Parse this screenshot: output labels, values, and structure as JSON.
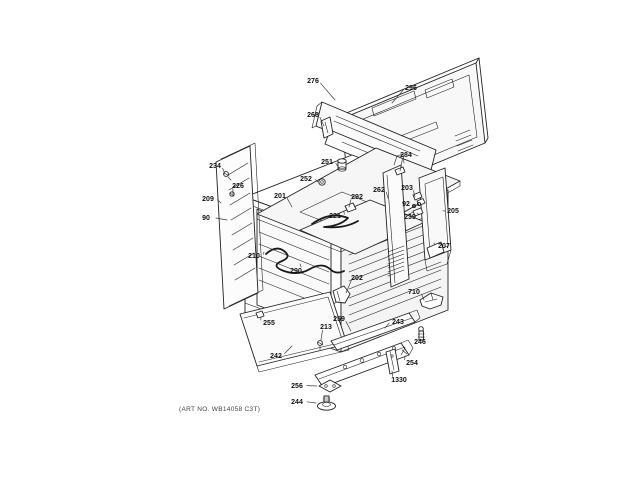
{
  "window": {
    "background": "#ffffff"
  },
  "diagram": {
    "kind": "exploded-parts-diagram",
    "subject": "range body assembly",
    "ink_color": "#222222",
    "label_color": "#111111",
    "art_note": "(ART NO. WB14058 C3T)",
    "labels": [
      {
        "text": "276",
        "x": 313,
        "y": 83,
        "tx": 335,
        "ty": 100
      },
      {
        "text": "296",
        "x": 411,
        "y": 90,
        "tx": 392,
        "ty": 103
      },
      {
        "text": "268",
        "x": 313,
        "y": 117,
        "tx": 324,
        "ty": 126
      },
      {
        "text": "284",
        "x": 406,
        "y": 157,
        "tx": 400,
        "ty": 171
      },
      {
        "text": "251",
        "x": 327,
        "y": 164,
        "tx": 339,
        "ty": 168
      },
      {
        "text": "252",
        "x": 306,
        "y": 181,
        "tx": 318,
        "ty": 182
      },
      {
        "text": "234",
        "x": 215,
        "y": 168,
        "tx": 225,
        "ty": 174
      },
      {
        "text": "226",
        "x": 238,
        "y": 188,
        "tx": 233,
        "ty": 194
      },
      {
        "text": "209",
        "x": 208,
        "y": 201,
        "tx": 221,
        "ty": 203
      },
      {
        "text": "90",
        "x": 206,
        "y": 220,
        "tx": 227,
        "ty": 220
      },
      {
        "text": "201",
        "x": 280,
        "y": 198,
        "tx": 292,
        "ty": 207
      },
      {
        "text": "292",
        "x": 357,
        "y": 199,
        "tx": 349,
        "ty": 207
      },
      {
        "text": "221",
        "x": 335,
        "y": 218,
        "tx": 344,
        "ty": 212
      },
      {
        "text": "262",
        "x": 379,
        "y": 192,
        "tx": 388,
        "ty": 198
      },
      {
        "text": "203",
        "x": 407,
        "y": 190,
        "tx": 415,
        "ty": 197
      },
      {
        "text": "92",
        "x": 406,
        "y": 206,
        "tx": 413,
        "ty": 206
      },
      {
        "text": "239",
        "x": 410,
        "y": 219,
        "tx": 417,
        "ty": 213
      },
      {
        "text": "205",
        "x": 453,
        "y": 213,
        "tx": 445,
        "ty": 211
      },
      {
        "text": "207",
        "x": 444,
        "y": 248,
        "tx": 434,
        "ty": 243
      },
      {
        "text": "210",
        "x": 254,
        "y": 258,
        "tx": 264,
        "ty": 252
      },
      {
        "text": "290",
        "x": 296,
        "y": 273,
        "tx": 300,
        "ty": 264
      },
      {
        "text": "202",
        "x": 357,
        "y": 280,
        "tx": 346,
        "ty": 293
      },
      {
        "text": "710",
        "x": 414,
        "y": 294,
        "tx": 424,
        "ty": 300
      },
      {
        "text": "255",
        "x": 269,
        "y": 325,
        "tx": 261,
        "ty": 317
      },
      {
        "text": "259",
        "x": 339,
        "y": 321,
        "tx": 351,
        "ty": 331
      },
      {
        "text": "213",
        "x": 326,
        "y": 329,
        "tx": 321,
        "ty": 340
      },
      {
        "text": "243",
        "x": 398,
        "y": 324,
        "tx": 385,
        "ty": 328
      },
      {
        "text": "246",
        "x": 420,
        "y": 344,
        "tx": 421,
        "ty": 337
      },
      {
        "text": "254",
        "x": 412,
        "y": 365,
        "tx": 405,
        "ty": 356
      },
      {
        "text": "1330",
        "x": 399,
        "y": 382,
        "tx": 392,
        "ty": 371
      },
      {
        "text": "242",
        "x": 276,
        "y": 358,
        "tx": 292,
        "ty": 346
      },
      {
        "text": "256",
        "x": 297,
        "y": 388,
        "tx": 317,
        "ty": 386
      },
      {
        "text": "244",
        "x": 297,
        "y": 404,
        "tx": 316,
        "ty": 403
      }
    ]
  }
}
